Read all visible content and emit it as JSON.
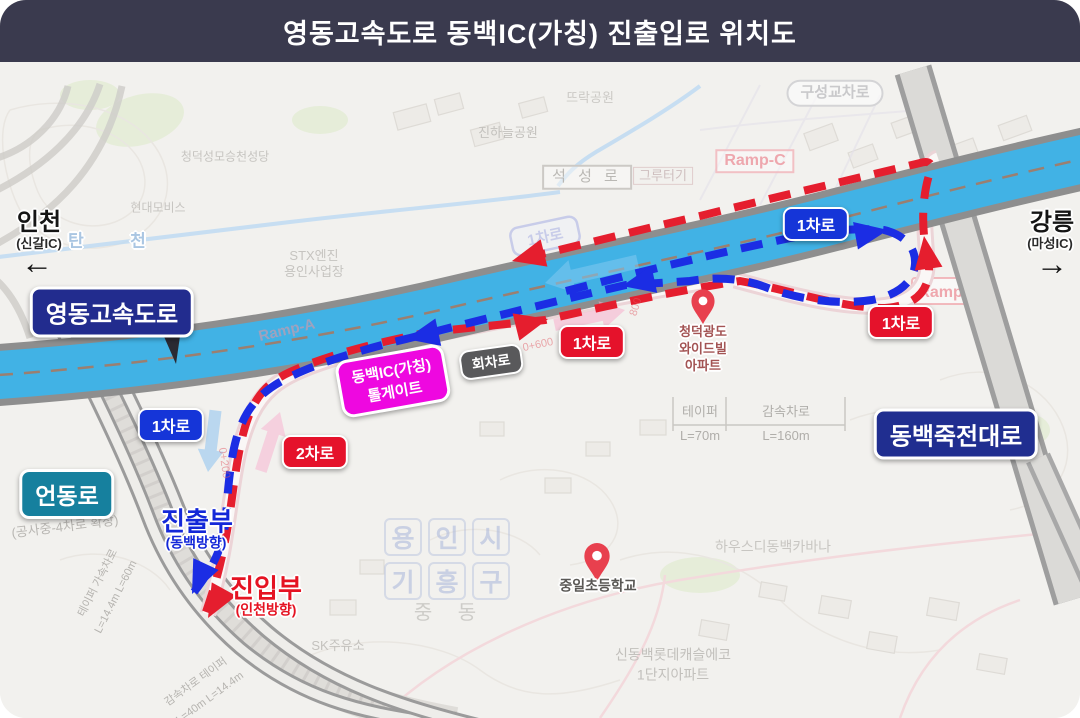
{
  "header": {
    "title": "영동고속도로 동백IC(가칭) 진출입로 위치도"
  },
  "endpoints": {
    "left_city": "인천",
    "left_ic": "(신갈IC)",
    "left_arrow": "←",
    "right_city": "강릉",
    "right_ic": "(마성IC)",
    "right_arrow": "→"
  },
  "badges": {
    "expressway": "영동고속도로",
    "eondongro": "언동로",
    "dongbaek_jukjeon_daero": "동백죽전대로",
    "tollgate_line1": "동백IC(가칭)",
    "tollgate_line2": "톨게이트",
    "turnaround": "회차로",
    "lane1": "1차로",
    "lane2": "2차로",
    "lane1_ghost": "1차로"
  },
  "flow": {
    "exit_label": "진출부",
    "exit_dir": "(동백방향)",
    "entry_label": "진입부",
    "entry_dir": "(인천방향)"
  },
  "dimensions": {
    "taper_label": "테이퍼",
    "taper_len": "L=70m",
    "decel_label": "감속차로",
    "decel_len": "L=160m",
    "left_dim1": "테이퍼 가속차로",
    "left_dim1_len": "L=14.4m L=60m",
    "left_dim2": "감속차로 테이퍼",
    "left_dim2_len": "L=40m L=14.4m",
    "construction": "(공사중-4차로 확장)"
  },
  "chainage": {
    "c600": "0+600",
    "c800": "800",
    "c200": "0+200"
  },
  "map_labels": {
    "church": "청덕성모승천성당",
    "hyundai_mobis": "현대모비스",
    "tan": "탄",
    "cheon": "천",
    "stx1": "STX엔진",
    "stx2": "용인사업장",
    "ttarak_park": "뜨락공원",
    "jinhaneul_park": "진하늘공원",
    "seokseong_ro": "석 성 로",
    "gruteogi": "그루터기",
    "ramp_a": "Ramp-A",
    "ramp_b": "Ramp-B",
    "ramp_c": "Ramp-C",
    "guseong_junction": "구성교차로",
    "apt1": "청덕광도",
    "apt2": "와이드빌",
    "apt3": "아파트",
    "yong": "용",
    "in": "인",
    "si": "시",
    "gi": "기",
    "heung": "흥",
    "gu": "구",
    "jungdong": "중  동",
    "school": "중일초등학교",
    "housd": "하우스디동백카바나",
    "lotte1": "신동백롯데캐슬에코",
    "lotte2": "1단지아파트",
    "sk_station": "SK주유소"
  },
  "colors": {
    "header_bg": "#3a3a4e",
    "highway_fill": "#41b2e5",
    "exit_path_blue": "#1b2de4",
    "entry_path_red": "#e51e2e",
    "tollgate_magenta": "#ee08e0",
    "expressway_badge_blue": "#222c8e",
    "eondongro_teal": "#16809e"
  }
}
